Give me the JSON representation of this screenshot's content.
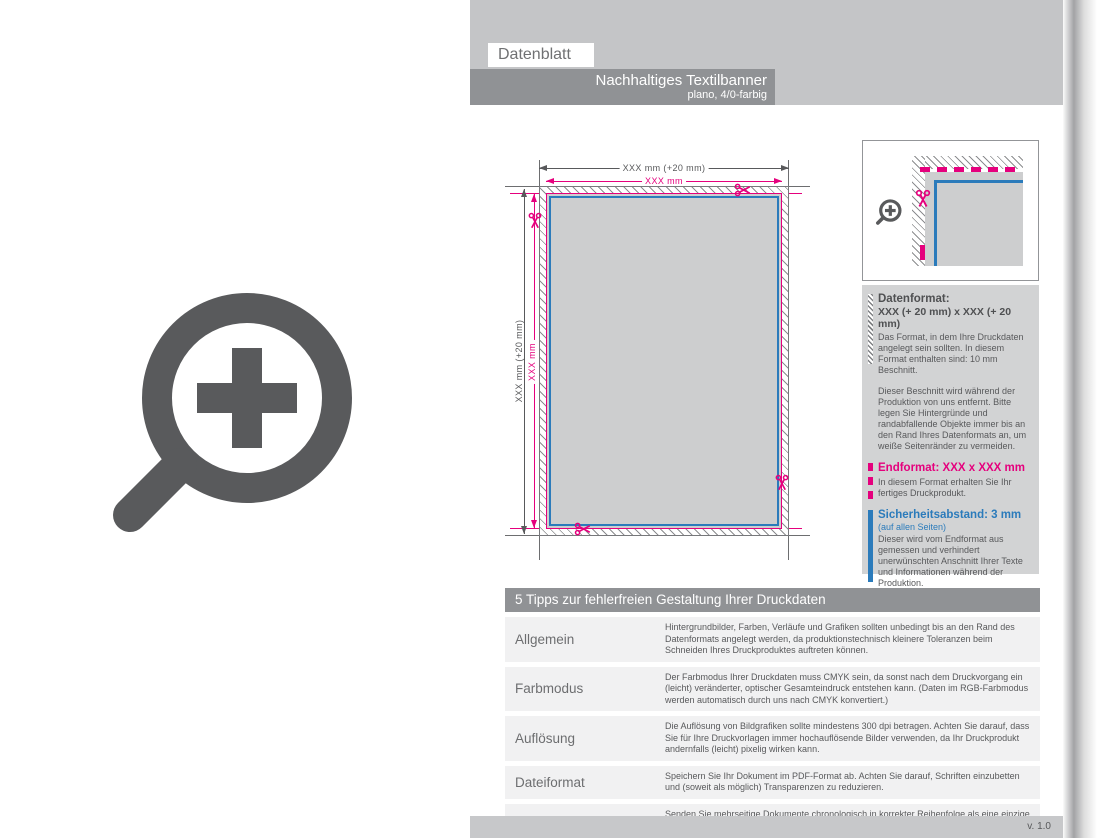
{
  "page": {
    "tab_label": "Datenblatt",
    "title": "Nachhaltiges Textilbanner",
    "subtitle": "plano, 4/0-farbig",
    "version": "v. 1.0"
  },
  "diagram": {
    "dim_top_outer": "XXX mm (+20 mm)",
    "dim_top_inner": "XXX mm",
    "dim_left_outer": "XXX mm (+20 mm)",
    "dim_left_inner": "XXX mm"
  },
  "legend": {
    "datenformat": {
      "title": "Datenformat:",
      "format": "XXX (+ 20 mm) x XXX (+ 20 mm)",
      "text1": "Das Format, in dem Ihre Druckdaten angelegt sein sollten. In diesem Format enthalten sind: 10 mm Beschnitt.",
      "text2": "Dieser Beschnitt wird während der Produktion von uns entfernt. Bitte legen Sie Hintergründe und randabfallende Objekte immer bis an den Rand Ihres Datenformats an, um weiße Seitenränder zu vermeiden."
    },
    "endformat": {
      "title": "Endformat: XXX x XXX mm",
      "text": "In diesem Format erhalten Sie Ihr fertiges Druckprodukt."
    },
    "sicherheitsabstand": {
      "title": "Sicherheitsabstand: 3 mm",
      "subtitle": "(auf allen Seiten)",
      "text": "Dieser wird vom Endformat aus gemessen und verhindert unerwünschten Anschnitt Ihrer Texte und Informationen während der Produktion."
    }
  },
  "tips": {
    "header": "5 Tipps zur fehlerfreien Gestaltung Ihrer Druckdaten",
    "rows": [
      {
        "label": "Allgemein",
        "text": "Hintergrundbilder, Farben, Verläufe und Grafiken sollten unbedingt bis an den Rand des Datenformats angelegt werden, da produktionstechnisch kleinere Toleranzen beim Schneiden Ihres Druckproduktes auftreten können."
      },
      {
        "label": "Farbmodus",
        "text": "Der Farbmodus Ihrer Druckdaten muss CMYK sein, da sonst nach dem Druckvorgang ein (leicht) veränderter, optischer Gesamteindruck entstehen kann. (Daten im RGB-Farbmodus werden automatisch durch uns nach CMYK konvertiert.)"
      },
      {
        "label": "Auflösung",
        "text": "Die Auflösung von Bildgrafiken sollte mindestens 300 dpi betragen. Achten Sie darauf, dass Sie für Ihre Druckvorlagen immer hochauflösende Bilder verwenden, da Ihr Druckprodukt andernfalls (leicht) pixelig wirken kann."
      },
      {
        "label": "Dateiformat",
        "text": "Speichern Sie Ihr Dokument im PDF-Format ab. Achten Sie darauf, Schriften einzubetten und (soweit als möglich) Transparenzen zu reduzieren."
      },
      {
        "label": "Seiten(-reihenfolge)",
        "text": "Senden Sie mehrseitige Dokumente chronologisch in korrekter Reihenfolge als eine einzige PDF-Datei oder benennen Sie Einzeldokumente entsprechend mit fortlaufenden Seitennummern."
      }
    ]
  },
  "icons": {
    "zoom_plus": "magnifier-with-plus",
    "scissors": "cut-here-scissors"
  },
  "colors": {
    "magenta": "#e5007d",
    "blue": "#2b7bbb",
    "dark_gray": "#58595b",
    "mid_gray": "#909295",
    "light_band": "#c4c5c7",
    "panel_bg": "#d2d3d4",
    "banner_fill": "#cdcecf",
    "row_bg": "#f1f1f2",
    "bottom_bar": "#c7c8ca"
  }
}
